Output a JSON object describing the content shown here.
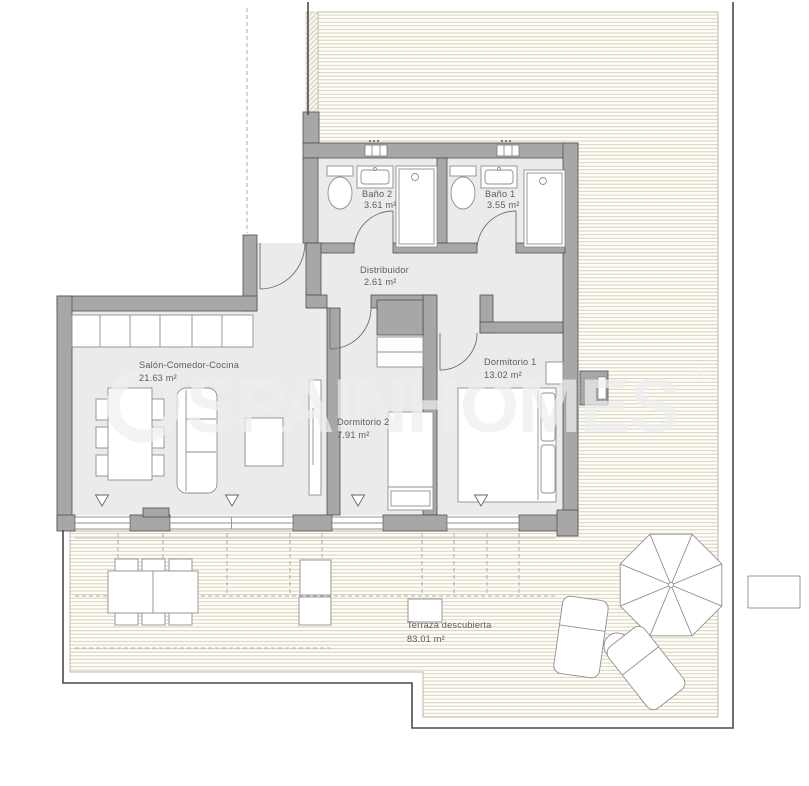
{
  "plan": {
    "title": "Apartment floor plan",
    "watermark": {
      "text": "SPAINHOMES",
      "registered": "®"
    },
    "rooms": [
      {
        "id": "bano2",
        "name": "Baño 2",
        "area": "3.61 m²"
      },
      {
        "id": "bano1",
        "name": "Baño 1",
        "area": "3.55 m²"
      },
      {
        "id": "distribuidor",
        "name": "Distribuidor",
        "area": "2.61 m²"
      },
      {
        "id": "salon",
        "name": "Salón-Comedor-Cocina",
        "area": "21.63 m²"
      },
      {
        "id": "dormitorio1",
        "name": "Dormitorio 1",
        "area": "13.02 m²"
      },
      {
        "id": "dormitorio2",
        "name": "Dormitorio 2",
        "area": "7.91 m²"
      },
      {
        "id": "terraza",
        "name": "Terraza descubierta",
        "area": "83.01 m²"
      }
    ],
    "colors": {
      "wall": "#a7a7a7",
      "wallStroke": "#4f4f4f",
      "floor": "#ebebeb",
      "deckLine": "#d7d0b8",
      "deckBg": "#fffefa",
      "boundary": "#4a4a4a",
      "label": "#5b5c5e",
      "furnitureStroke": "#8f8f8f"
    }
  }
}
